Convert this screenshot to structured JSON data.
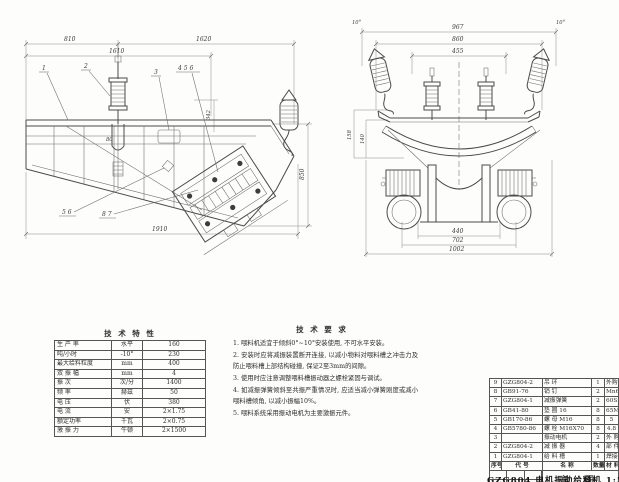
{
  "side_view": {
    "dims": {
      "d810": "810",
      "d1620": "1620",
      "d1610": "1610",
      "d1910": "1910",
      "d850": "850",
      "d342": "342",
      "d80": "80"
    },
    "callouts": {
      "c1": "1",
      "c2": "2",
      "c3": "3",
      "c456": "4 5 6",
      "c56": "5 6",
      "c87": "8 7"
    }
  },
  "front_view": {
    "dims": {
      "d967": "967",
      "d860": "860",
      "d455": "455",
      "d440": "440",
      "d702": "702",
      "d1002": "1002",
      "d158": "158",
      "d140": "140",
      "angle_left": "10°",
      "angle_right": "10°"
    }
  },
  "spec_table": {
    "title": "技 术 特 性",
    "rows": [
      {
        "label": "生 产 率",
        "unit": "水平",
        "value": "160"
      },
      {
        "label": "吨/小时",
        "unit": "-10°",
        "value": "230"
      },
      {
        "label": "最大给料粒度",
        "unit": "mm",
        "value": "400"
      },
      {
        "label": "双 振 幅",
        "unit": "mm",
        "value": "4"
      },
      {
        "label": "振  次",
        "unit": "次/分",
        "value": "1400"
      },
      {
        "label": "频  率",
        "unit": "赫兹",
        "value": "50"
      },
      {
        "label": "电  压",
        "unit": "伏",
        "value": "380"
      },
      {
        "label": "电  流",
        "unit": "安",
        "value": "2×1.75"
      },
      {
        "label": "额定功率",
        "unit": "千瓦",
        "value": "2×0.75"
      },
      {
        "label": "激 振 力",
        "unit": "牛顿",
        "value": "2×1500"
      }
    ]
  },
  "tech_notes": {
    "title": "技 术 要 求",
    "items": [
      "1. 喂料机适宜于倾斜0°~10°安装使用, 不可水平安装。",
      "2. 安装时应将减振装置断开连接, 以减小物料对喂料槽之冲击力及防止喂料槽上部结构碰撞, 保证2至3mm的间隙。",
      "3. 使用时应注意调整喂料槽振动器之螺栓紧固与调试。",
      "4. 如减振弹簧倾斜至共振严重情况时, 应适当减小弹簧刚度或减小喂料槽倾角, 以减小振幅10%。",
      "5. 喂料系统采用振动电机为主要激振元件。"
    ]
  },
  "parts_table": {
    "headers": {
      "seq": "序号",
      "code": "代  号",
      "name": "名  称",
      "qty": "数量",
      "material": "材 料"
    },
    "rows": [
      {
        "seq": "9",
        "code": "GZG804-2",
        "name": "吊 环",
        "qty": "1",
        "material": "外购"
      },
      {
        "seq": "8",
        "code": "GB91-76",
        "name": "销 钉",
        "qty": "2",
        "material": "Mn65"
      },
      {
        "seq": "7",
        "code": "GZG804-1",
        "name": "减振弹簧",
        "qty": "2",
        "material": "60Si2Mn"
      },
      {
        "seq": "6",
        "code": "GB41-80",
        "name": "垫 圈 16",
        "qty": "8",
        "material": "65Mn"
      },
      {
        "seq": "5",
        "code": "GB170-86",
        "name": "螺 母 M16",
        "qty": "8",
        "material": "5"
      },
      {
        "seq": "4",
        "code": "GB5780-86",
        "name": "螺 栓 M16X70",
        "qty": "8",
        "material": "4.8"
      },
      {
        "seq": "3",
        "code": "",
        "name": "振动电机",
        "qty": "2",
        "material": "外 购"
      },
      {
        "seq": "2",
        "code": "GZG804-2",
        "name": "减 振 器",
        "qty": "4",
        "material": "部 件"
      },
      {
        "seq": "1",
        "code": "GZG804-1",
        "name": "给 料 槽",
        "qty": "1",
        "material": "焊接件"
      }
    ],
    "title_block": {
      "drawing_name": "总  图",
      "footer": "GZG804 电机振动给料机 1:5"
    }
  }
}
